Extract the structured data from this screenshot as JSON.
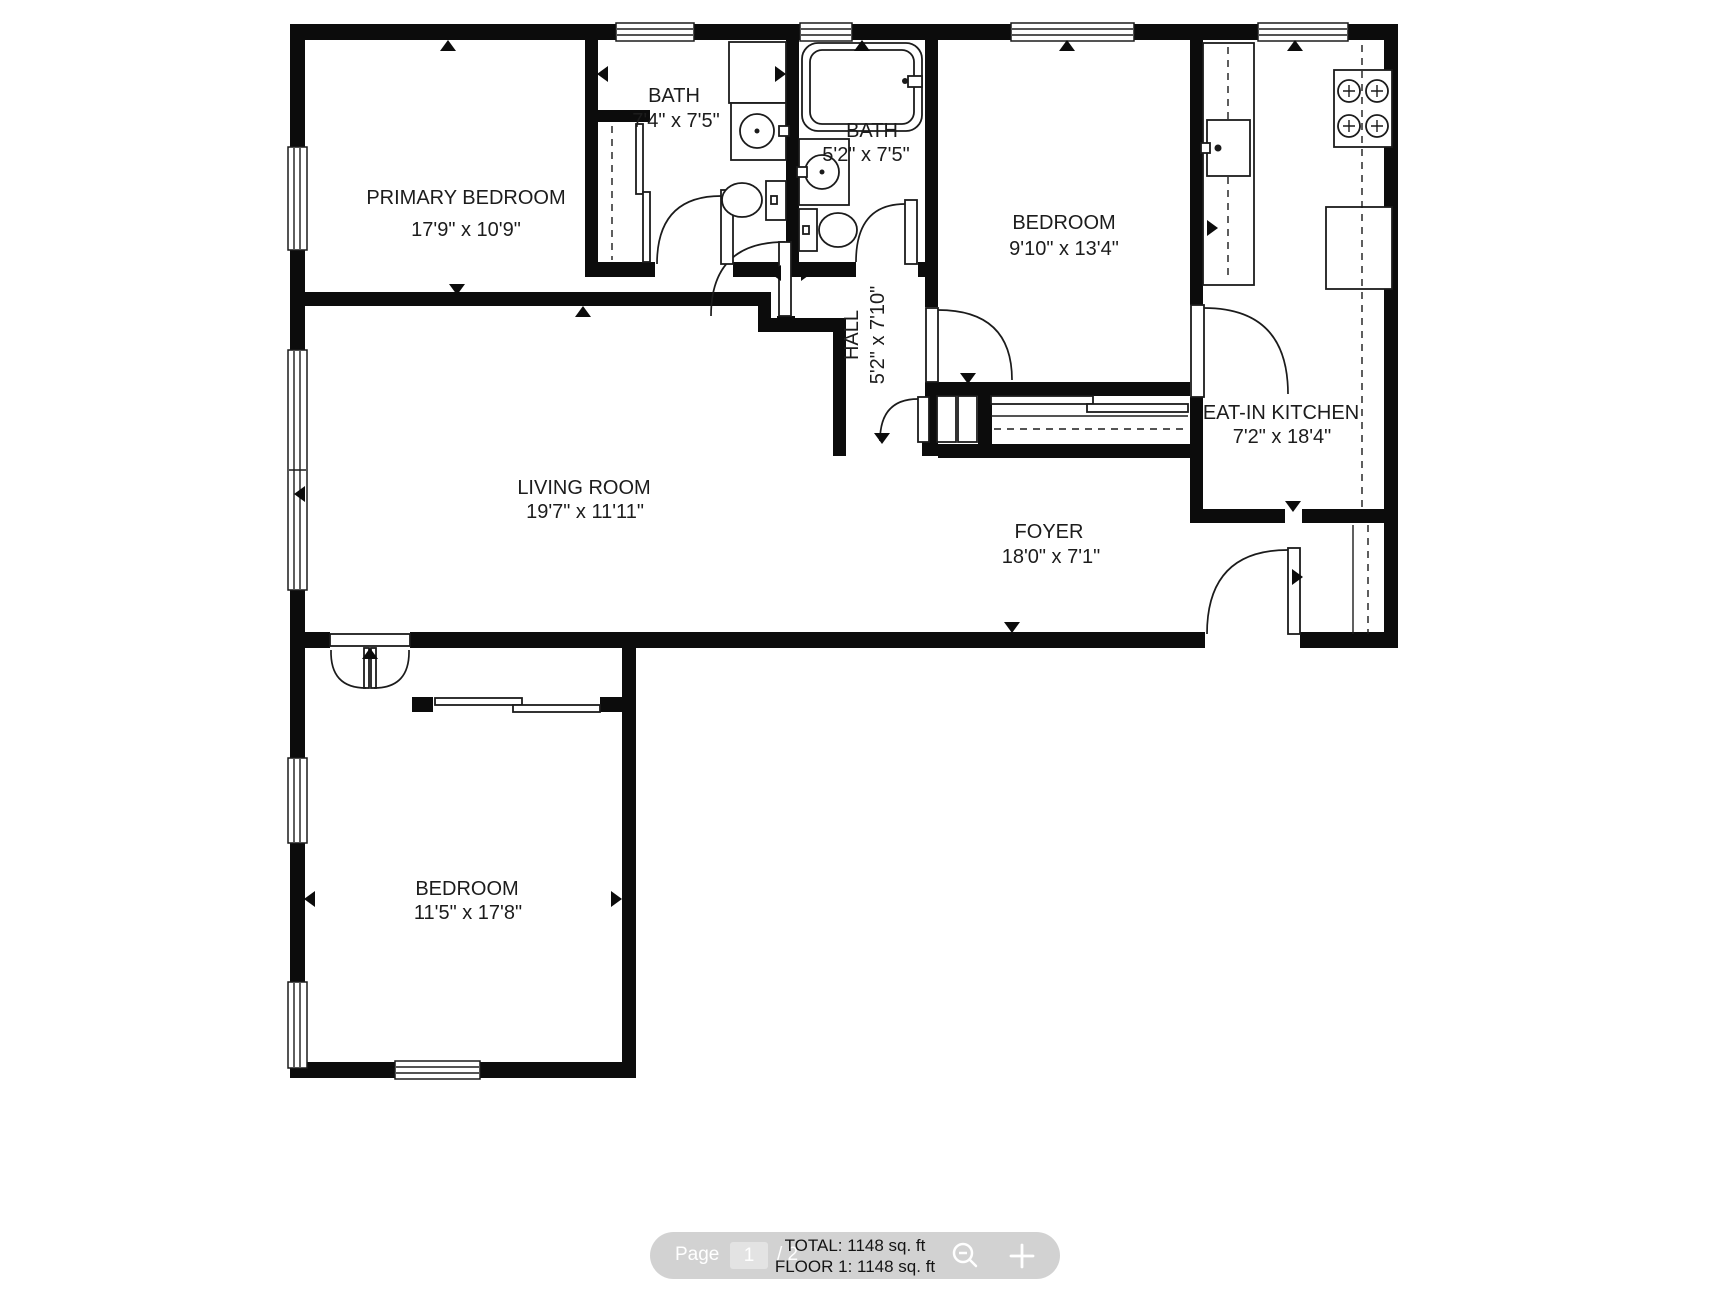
{
  "plan": {
    "rooms": {
      "primary_bedroom": {
        "name": "PRIMARY BEDROOM",
        "dims": "17'9\" x 10'9\""
      },
      "bath1": {
        "name": "BATH",
        "dims": "7'4\" x 7'5\""
      },
      "bath2": {
        "name": "BATH",
        "dims": "5'2\" x 7'5\""
      },
      "bedroom_top": {
        "name": "BEDROOM",
        "dims": "9'10\" x 13'4\""
      },
      "hall": {
        "name": "HALL",
        "dims": "5'2\" x 7'10\""
      },
      "living_room": {
        "name": "LIVING ROOM",
        "dims": "19'7\" x 11'11\""
      },
      "kitchen": {
        "name": "EAT-IN KITCHEN",
        "dims": "7'2\" x 18'4\""
      },
      "foyer": {
        "name": "FOYER",
        "dims": "18'0\" x 7'1\""
      },
      "bedroom_bottom": {
        "name": "BEDROOM",
        "dims": "11'5\" x 17'8\""
      }
    }
  },
  "toolbar": {
    "page_label": "Page",
    "page_value": "1",
    "page_total": "/ 2",
    "total_text": "TOTAL: 1148 sq. ft",
    "floor_text": "FLOOR 1: 1148 sq. ft",
    "icons": {
      "zoom_out": "magnifier-minus-icon",
      "zoom_in": "plus-icon"
    },
    "colors": {
      "bar": "#d2d2d2",
      "bar_text": "#ffffff",
      "overlay_text": "#141414"
    }
  }
}
